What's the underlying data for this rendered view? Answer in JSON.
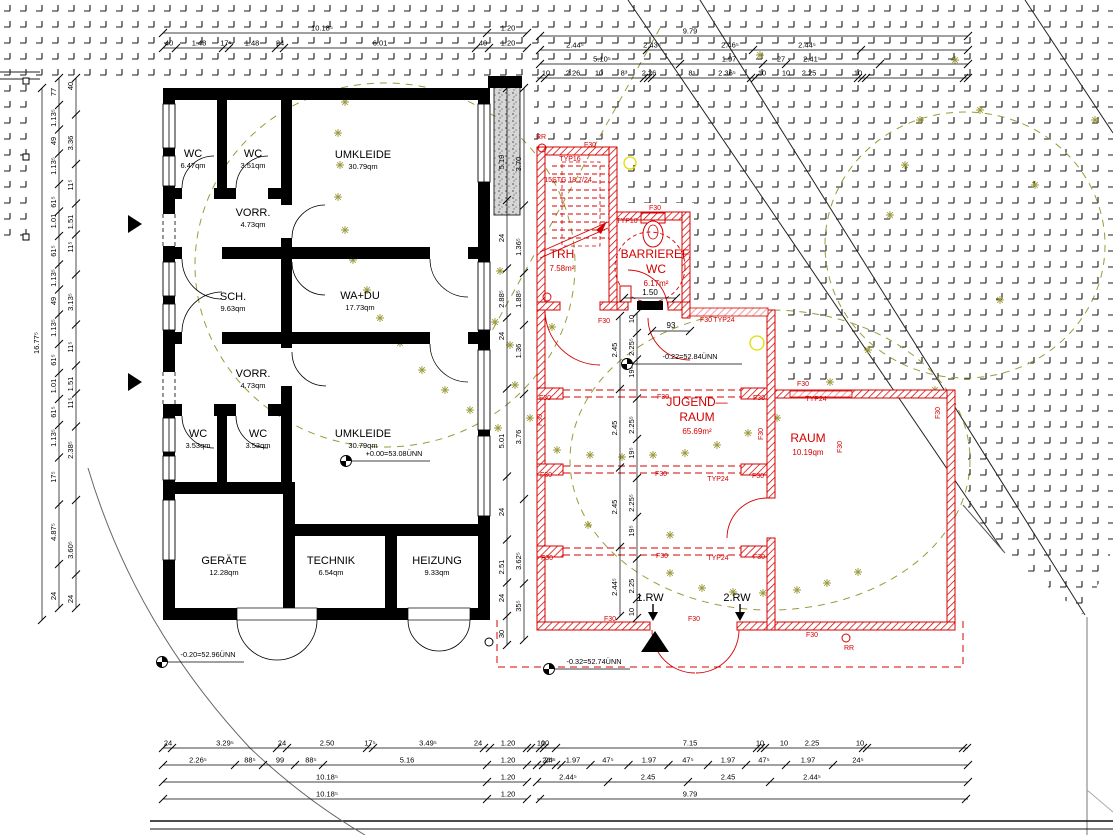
{
  "drawing_type": "architectural floor plan (ground floor, existing + new construction)",
  "colors": {
    "existing_walls": "#000000",
    "new_construction": "#d40000",
    "lintel_pink": "#f2a2a2",
    "landscape_olive": "#9a9a3a",
    "accent_yellow": "#dede00",
    "paving_mark": "#1a1a1a"
  },
  "existing_building": {
    "rooms": [
      {
        "name": "WC",
        "area": "6.47qm",
        "x": 193,
        "y": 157
      },
      {
        "name": "WC",
        "area": "3.51qm",
        "x": 253,
        "y": 157
      },
      {
        "name": "UMKLEIDE",
        "area": "30.79qm",
        "x": 363,
        "y": 158
      },
      {
        "name": "VORR.",
        "area": "4.73qm",
        "x": 253,
        "y": 216
      },
      {
        "name": "SCH.",
        "area": "9.63qm",
        "x": 233,
        "y": 300
      },
      {
        "name": "WA+DU",
        "area": "17.73qm",
        "x": 360,
        "y": 299
      },
      {
        "name": "VORR.",
        "area": "4.73qm",
        "x": 253,
        "y": 377
      },
      {
        "name": "WC",
        "area": "3.53qm",
        "x": 198,
        "y": 437
      },
      {
        "name": "WC",
        "area": "3.53qm",
        "x": 258,
        "y": 437
      },
      {
        "name": "UMKLEIDE",
        "area": "30.79qm",
        "x": 363,
        "y": 437
      },
      {
        "name": "GERÄTE",
        "area": "12.28qm",
        "x": 224,
        "y": 564
      },
      {
        "name": "TECHNIK",
        "area": "6.54qm",
        "x": 331,
        "y": 564
      },
      {
        "name": "HEIZUNG",
        "area": "9.33qm",
        "x": 437,
        "y": 564
      }
    ]
  },
  "new_building": {
    "rooms": [
      {
        "lines": [
          "TRH"
        ],
        "area": "7.58m²",
        "x": 562,
        "y": 258
      },
      {
        "lines": [
          "BARRIEREF.",
          "WC"
        ],
        "area": "6.17m²",
        "x": 656,
        "y": 258
      },
      {
        "lines": [
          "JUGEND—",
          "RAUM"
        ],
        "area": "65.69m²",
        "x": 697,
        "y": 406
      },
      {
        "lines": [
          "RAUM"
        ],
        "area": "10.19qm",
        "x": 808,
        "y": 442
      }
    ],
    "tags": [
      {
        "t": "RR",
        "x": 541,
        "y": 139
      },
      {
        "t": "F30",
        "x": 590,
        "y": 147
      },
      {
        "t": "TYP16",
        "x": 570,
        "y": 161
      },
      {
        "t": "15STG 18.7/24",
        "x": 568,
        "y": 182
      },
      {
        "t": "TYP10",
        "x": 627,
        "y": 223
      },
      {
        "t": "F30",
        "x": 655,
        "y": 210
      },
      {
        "t": "F30",
        "x": 604,
        "y": 323
      },
      {
        "t": "F30",
        "x": 706,
        "y": 322
      },
      {
        "t": "TYP24",
        "x": 724,
        "y": 322
      },
      {
        "t": "F30",
        "x": 545,
        "y": 400
      },
      {
        "t": "F30",
        "x": 663,
        "y": 399
      },
      {
        "t": "F30",
        "x": 759,
        "y": 400
      },
      {
        "t": "F30",
        "x": 803,
        "y": 386
      },
      {
        "t": "TYP24",
        "x": 816,
        "y": 401
      },
      {
        "t": "F30",
        "x": 542,
        "y": 420,
        "rot": 1
      },
      {
        "t": "F30",
        "x": 763,
        "y": 434,
        "rot": 1
      },
      {
        "t": "F30",
        "x": 842,
        "y": 447,
        "rot": 1
      },
      {
        "t": "F30",
        "x": 940,
        "y": 413,
        "rot": 1
      },
      {
        "t": "F30",
        "x": 546,
        "y": 477
      },
      {
        "t": "F30",
        "x": 661,
        "y": 476
      },
      {
        "t": "TYP24",
        "x": 718,
        "y": 481
      },
      {
        "t": "F30",
        "x": 758,
        "y": 478
      },
      {
        "t": "F30",
        "x": 547,
        "y": 560
      },
      {
        "t": "F30",
        "x": 662,
        "y": 558
      },
      {
        "t": "TYP24",
        "x": 718,
        "y": 560
      },
      {
        "t": "F30",
        "x": 759,
        "y": 559
      },
      {
        "t": "F30",
        "x": 610,
        "y": 621
      },
      {
        "t": "F30",
        "x": 694,
        "y": 621
      },
      {
        "t": "F30",
        "x": 812,
        "y": 637
      },
      {
        "t": "RR",
        "x": 849,
        "y": 650
      }
    ],
    "entry_labels": [
      {
        "t": "1.RW",
        "x": 650,
        "y": 601
      },
      {
        "t": "2.RW",
        "x": 737,
        "y": 601
      }
    ]
  },
  "levels": [
    {
      "t": "+0.00=53.08ÜNN",
      "sx": 346,
      "sy": 461,
      "lx2": 430,
      "tx": 394,
      "ty": 456
    },
    {
      "t": "-0.20=52.96ÜNN",
      "sx": 162,
      "sy": 662,
      "lx2": 244,
      "tx": 208,
      "ty": 657
    },
    {
      "t": "-0.32=52.74ÜNN",
      "sx": 549,
      "sy": 669,
      "lx2": 630,
      "tx": 594,
      "ty": 664
    },
    {
      "t": "-0.22=52.84ÜNN",
      "sx": 627,
      "sy": 364,
      "lx2": 742,
      "tx": 690,
      "ty": 359
    }
  ],
  "extra_dims": [
    {
      "t": "1.50",
      "x": 650,
      "y": 295,
      "line": [
        624,
        298,
        676,
        298
      ]
    },
    {
      "t": "93",
      "x": 671,
      "y": 328,
      "line": [
        652,
        331,
        690,
        331
      ]
    }
  ],
  "h_chains": [
    {
      "y": 33,
      "x1": 163,
      "x2": 527,
      "ticks": [
        163,
        487,
        527
      ],
      "labels": [
        {
          "t": "10.18⁵",
          "x": 322
        },
        {
          "t": "1.20",
          "x": 508
        }
      ]
    },
    {
      "y": 48,
      "x1": 163,
      "x2": 527,
      "ticks": [
        163,
        176,
        223,
        229,
        276,
        284,
        476,
        489,
        527
      ],
      "labels": [
        {
          "t": "40",
          "x": 169
        },
        {
          "t": "1.48",
          "x": 199
        },
        {
          "t": "17⁵",
          "x": 226
        },
        {
          "t": "1.48",
          "x": 252
        },
        {
          "t": "24",
          "x": 280
        },
        {
          "t": "6.01",
          "x": 380
        },
        {
          "t": "40",
          "x": 483
        },
        {
          "t": "1.20",
          "x": 508
        }
      ]
    },
    {
      "y": 36,
      "x1": 540,
      "x2": 968,
      "ticks": [
        540,
        968
      ],
      "labels": [
        {
          "t": "9.79",
          "x": 690
        }
      ]
    },
    {
      "y": 50,
      "x1": 540,
      "x2": 968,
      "ticks": [
        540,
        647,
        753,
        861,
        968
      ],
      "labels": [
        {
          "t": "2.44⁵",
          "x": 575
        },
        {
          "t": "2.43⁵",
          "x": 652
        },
        {
          "t": "2.46⁵",
          "x": 730
        },
        {
          "t": "2.44⁵",
          "x": 807
        }
      ]
    },
    {
      "y": 64,
      "x1": 540,
      "x2": 968,
      "ticks": [
        540,
        680,
        763,
        786,
        880,
        968
      ],
      "labels": [
        {
          "t": "5.10⁵",
          "x": 602
        },
        {
          "t": "1.97",
          "x": 729
        },
        {
          "t": "27",
          "x": 781
        },
        {
          "t": "2.41⁵",
          "x": 812
        }
      ]
    },
    {
      "y": 78,
      "x1": 537,
      "x2": 968,
      "ticks": [
        540,
        545,
        644,
        648,
        652,
        751,
        755,
        858,
        862,
        866,
        964,
        968
      ],
      "labels": [
        {
          "t": "10",
          "x": 546
        },
        {
          "t": "2.26",
          "x": 573
        },
        {
          "t": "10",
          "x": 599
        },
        {
          "t": "8³",
          "x": 624
        },
        {
          "t": "2.26",
          "x": 649
        },
        {
          "t": "8⁵",
          "x": 692
        },
        {
          "t": "2.36⁵",
          "x": 727
        },
        {
          "t": "10",
          "x": 762
        },
        {
          "t": "10",
          "x": 786
        },
        {
          "t": "2.25",
          "x": 809
        },
        {
          "t": "10",
          "x": 858
        }
      ]
    },
    {
      "y": 748,
      "x1": 163,
      "x2": 556,
      "ticks": [
        163,
        172,
        277,
        287,
        367,
        373,
        484,
        490,
        527,
        531,
        556
      ],
      "labels": [
        {
          "t": "24",
          "x": 168
        },
        {
          "t": "3.29⁵",
          "x": 225
        },
        {
          "t": "24",
          "x": 282
        },
        {
          "t": "2.50",
          "x": 327
        },
        {
          "t": "17⁵",
          "x": 370
        },
        {
          "t": "3.49⁵",
          "x": 428
        },
        {
          "t": "24",
          "x": 478
        },
        {
          "t": "1.20",
          "x": 508
        },
        {
          "t": "10",
          "x": 541
        }
      ]
    },
    {
      "y": 765,
      "x1": 163,
      "x2": 556,
      "ticks": [
        163,
        235,
        263,
        295,
        323,
        487,
        527,
        543,
        556
      ],
      "labels": [
        {
          "t": "2.26⁵",
          "x": 198
        },
        {
          "t": "88⁵",
          "x": 250
        },
        {
          "t": "99",
          "x": 280
        },
        {
          "t": "88⁵",
          "x": 311
        },
        {
          "t": "5.16",
          "x": 407
        },
        {
          "t": "1.20",
          "x": 508
        },
        {
          "t": "24⁵",
          "x": 548
        }
      ]
    },
    {
      "y": 782,
      "x1": 163,
      "x2": 527,
      "ticks": [
        163,
        487,
        527
      ],
      "labels": [
        {
          "t": "10.18⁵",
          "x": 327
        },
        {
          "t": "1.20",
          "x": 508
        }
      ]
    },
    {
      "y": 799,
      "x1": 163,
      "x2": 527,
      "ticks": [
        163,
        487,
        527
      ],
      "labels": [
        {
          "t": "10.18⁵",
          "x": 327
        },
        {
          "t": "1.20",
          "x": 508
        }
      ]
    },
    {
      "y": 748,
      "x1": 537,
      "x2": 968,
      "ticks": [
        540,
        544,
        757,
        761,
        765,
        863,
        867,
        963,
        967
      ],
      "labels": [
        {
          "t": "10",
          "x": 545
        },
        {
          "t": "7.15",
          "x": 690
        },
        {
          "t": "10",
          "x": 760
        },
        {
          "t": "10",
          "x": 784
        },
        {
          "t": "2.25",
          "x": 812
        },
        {
          "t": "10",
          "x": 860
        }
      ]
    },
    {
      "y": 765,
      "x1": 537,
      "x2": 968,
      "labels": [
        {
          "t": "24⁵",
          "x": 550
        },
        {
          "t": "1.97",
          "x": 573
        },
        {
          "t": "47⁵",
          "x": 608
        },
        {
          "t": "1.97",
          "x": 649
        },
        {
          "t": "47⁵",
          "x": 688
        },
        {
          "t": "1.97",
          "x": 728
        },
        {
          "t": "47⁵",
          "x": 764
        },
        {
          "t": "1.97",
          "x": 808
        },
        {
          "t": "24⁵",
          "x": 858
        }
      ]
    },
    {
      "y": 782,
      "x1": 537,
      "x2": 968,
      "labels": [
        {
          "t": "2.44⁵",
          "x": 568
        },
        {
          "t": "2.45",
          "x": 648
        },
        {
          "t": "2.45",
          "x": 728
        },
        {
          "t": "2.44⁵",
          "x": 812
        }
      ]
    },
    {
      "y": 799,
      "x1": 537,
      "x2": 968,
      "ticks": [
        540,
        966
      ],
      "labels": [
        {
          "t": "9.79",
          "x": 690
        }
      ]
    }
  ],
  "v_chains": [
    {
      "x": 42,
      "y1": 88,
      "y2": 620,
      "ticks": [
        88,
        620
      ],
      "labels": [
        {
          "t": "16.77⁵",
          "y": 343
        }
      ]
    },
    {
      "x": 59,
      "y1": 78,
      "y2": 608,
      "labels": [
        {
          "t": "77",
          "y": 92
        },
        {
          "t": "1.13⁵",
          "y": 118
        },
        {
          "t": "49",
          "y": 141
        },
        {
          "t": "1.13⁵",
          "y": 166
        },
        {
          "t": "61⁵",
          "y": 202
        },
        {
          "t": "1.01",
          "y": 221
        },
        {
          "t": "61⁵",
          "y": 251
        },
        {
          "t": "1.13⁵",
          "y": 278
        },
        {
          "t": "49",
          "y": 301
        },
        {
          "t": "1.13⁵",
          "y": 328
        },
        {
          "t": "61⁵",
          "y": 360
        },
        {
          "t": "1.01",
          "y": 386
        },
        {
          "t": "61⁵",
          "y": 412
        },
        {
          "t": "1.13⁵",
          "y": 438
        },
        {
          "t": "17⁵",
          "y": 477
        },
        {
          "t": "4.87⁵",
          "y": 532
        },
        {
          "t": "24",
          "y": 596
        }
      ]
    },
    {
      "x": 76,
      "y1": 78,
      "y2": 608,
      "labels": [
        {
          "t": "40",
          "y": 86
        },
        {
          "t": "3.36",
          "y": 143
        },
        {
          "t": "11⁵",
          "y": 185
        },
        {
          "t": "1.51",
          "y": 222
        },
        {
          "t": "11⁵",
          "y": 247
        },
        {
          "t": "3.13⁵",
          "y": 302
        },
        {
          "t": "11⁵",
          "y": 347
        },
        {
          "t": "1.51",
          "y": 384
        },
        {
          "t": "11⁵",
          "y": 403
        },
        {
          "t": "2.38⁵",
          "y": 450
        },
        {
          "t": "3.60⁵",
          "y": 550
        },
        {
          "t": "24",
          "y": 599
        }
      ]
    },
    {
      "x": 507,
      "y1": 88,
      "y2": 645,
      "labels": [
        {
          "t": "5.19",
          "y": 162
        },
        {
          "t": "24",
          "y": 238
        },
        {
          "t": "2.88⁵",
          "y": 299
        },
        {
          "t": "24",
          "y": 336
        },
        {
          "t": "5.01",
          "y": 441
        },
        {
          "t": "24",
          "y": 512
        },
        {
          "t": "2.51",
          "y": 567
        },
        {
          "t": "24",
          "y": 598
        },
        {
          "t": "30",
          "y": 634
        }
      ]
    },
    {
      "x": 524,
      "y1": 88,
      "y2": 640,
      "labels": [
        {
          "t": "3.70",
          "y": 164
        },
        {
          "t": "1.36⁵",
          "y": 247
        },
        {
          "t": "1.88⁵",
          "y": 299
        },
        {
          "t": "1.36",
          "y": 351
        },
        {
          "t": "3.76",
          "y": 437
        },
        {
          "t": "3.62⁵",
          "y": 561
        },
        {
          "t": "35⁵",
          "y": 606
        }
      ]
    },
    {
      "x": 620,
      "y1": 316,
      "y2": 616,
      "labels": [
        {
          "t": "2.45",
          "y": 350
        },
        {
          "t": "2.45",
          "y": 428
        },
        {
          "t": "2.45",
          "y": 507
        },
        {
          "t": "2.44⁵",
          "y": 587
        }
      ]
    },
    {
      "x": 637,
      "y1": 313,
      "y2": 618,
      "labels": [
        {
          "t": "10",
          "y": 319
        },
        {
          "t": "2.25⁵",
          "y": 347
        },
        {
          "t": "19⁵",
          "y": 372
        },
        {
          "t": "2.25⁵",
          "y": 425
        },
        {
          "t": "19⁵",
          "y": 453
        },
        {
          "t": "2.25⁵",
          "y": 503
        },
        {
          "t": "19⁵",
          "y": 531
        },
        {
          "t": "2.25",
          "y": 586
        },
        {
          "t": "10",
          "y": 612
        }
      ]
    }
  ]
}
